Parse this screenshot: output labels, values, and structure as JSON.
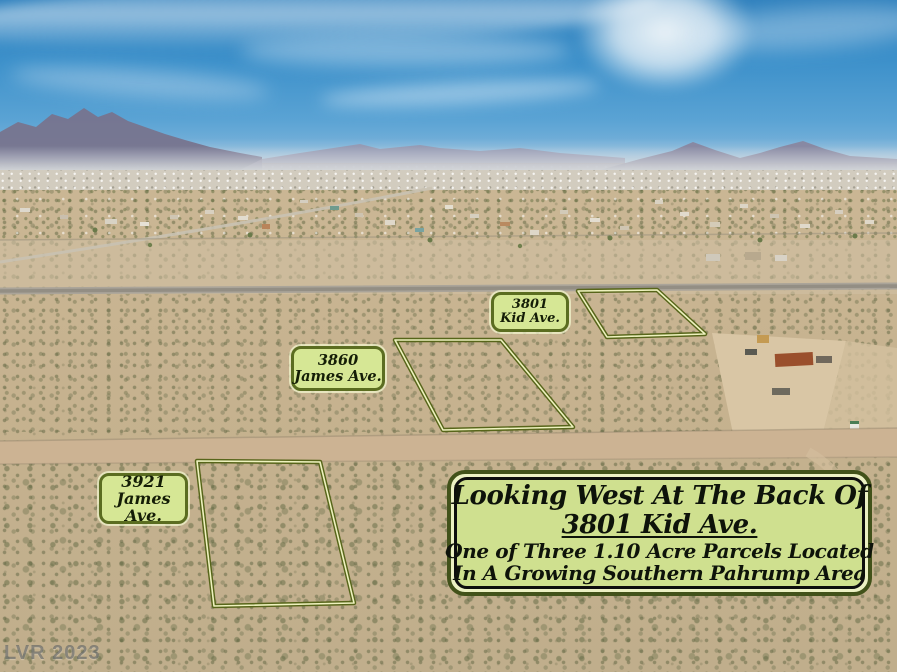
{
  "parcel_labels": [
    {
      "address": "3801",
      "street": "Kid Ave."
    },
    {
      "address": "3860",
      "street": "James Ave."
    },
    {
      "address": "3921",
      "street": "James Ave."
    }
  ],
  "info_box": {
    "line1": "Looking West At The Back Of",
    "line2": "3801 Kid Ave.",
    "line3": "One of Three 1.10 Acre Parcels Located",
    "line4": "In A Growing Southern Pahrump Area"
  },
  "watermark": "LVR 2023",
  "colors": {
    "parcel_outline_outer": "#57651a",
    "parcel_outline_inner": "#eef2be",
    "label_fill": "#d6e795",
    "label_border": "#5b6d21",
    "info_box_fill": "#cfe08f",
    "info_box_border_outer": "#42521a",
    "info_box_border_inner": "#0d0d0d",
    "sky_blue": "#3c90ca",
    "desert_tan": "#c6b38f"
  }
}
